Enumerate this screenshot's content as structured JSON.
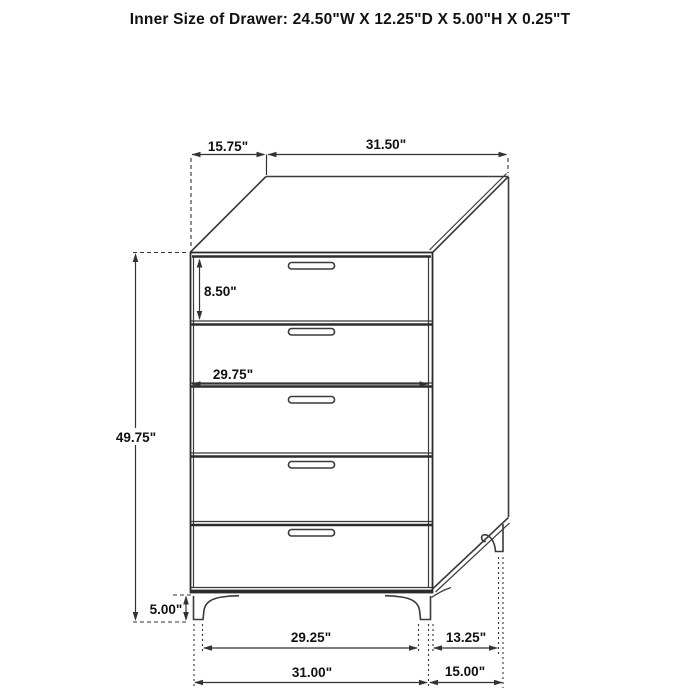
{
  "title": "Inner Size of Drawer: 24.50\"W X 12.25\"D X 5.00\"H X 0.25\"T",
  "figure": {
    "item": "five-drawer chest",
    "view": "front-right perspective line drawing",
    "drawer_count": 5
  },
  "dimension_labels": {
    "top_depth": "15.75\"",
    "top_width": "31.50\"",
    "drawer_height": "8.50\"",
    "drawer_width": "29.75\"",
    "body_height": "49.75\"",
    "leg_height": "5.00\"",
    "front_leg_span": "29.25\"",
    "side_leg_span": "13.25\"",
    "overall_width": "31.00\"",
    "overall_depth": "15.00\""
  },
  "colors": {
    "background": "#ffffff",
    "line": "#3a3a3a",
    "text": "#111111"
  }
}
